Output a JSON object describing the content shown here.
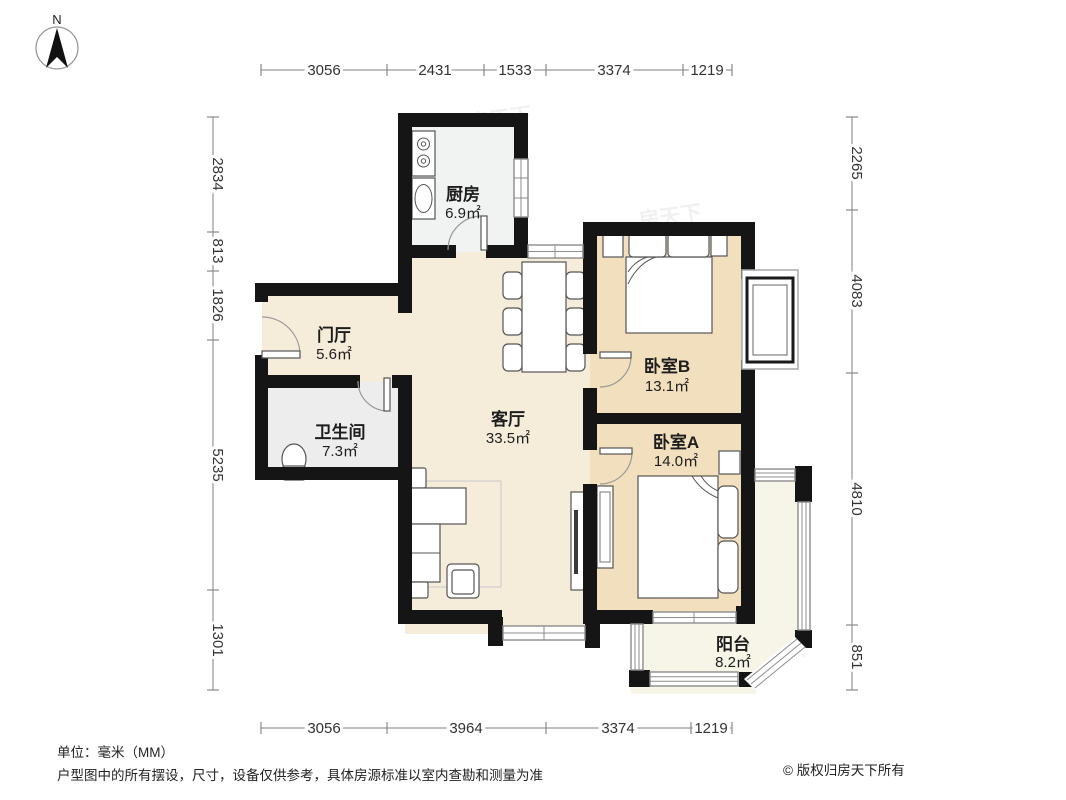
{
  "compass": {
    "label": "N"
  },
  "rooms": {
    "kitchen": {
      "name": "厨房",
      "area": "6.9㎡"
    },
    "foyer": {
      "name": "门厅",
      "area": "5.6㎡"
    },
    "bathroom": {
      "name": "卫生间",
      "area": "7.3㎡"
    },
    "living": {
      "name": "客厅",
      "area": "33.5㎡"
    },
    "bedroom_b": {
      "name": "卧室B",
      "area": "13.1㎡"
    },
    "bedroom_a": {
      "name": "卧室A",
      "area": "14.0㎡"
    },
    "balcony": {
      "name": "阳台",
      "area": "8.2㎡"
    }
  },
  "dimensions": {
    "top": [
      "3056",
      "2431",
      "1533",
      "3374",
      "1219"
    ],
    "bottom": [
      "3056",
      "3964",
      "3374",
      "1219"
    ],
    "left": [
      "2834",
      "813",
      "1826",
      "5235",
      "1301"
    ],
    "right": [
      "2265",
      "4083",
      "4810",
      "851"
    ]
  },
  "watermark": "房天下",
  "footer": {
    "unit": "单位：毫米（MM）",
    "disclaimer": "户型图中的所有摆设，尺寸，设备仅供参考，具体房源标准以室内查勘和测量为准",
    "copyright": "© 版权归房天下所有"
  },
  "colors": {
    "wall": "#151515",
    "floor_living": "#f5ecda",
    "floor_bedroom": "#f2dfbd",
    "floor_kitchen": "#f1f2f2",
    "floor_bathroom": "#ededee",
    "floor_balcony": "#f7f4e8",
    "window_line": "#8c8c8c"
  }
}
